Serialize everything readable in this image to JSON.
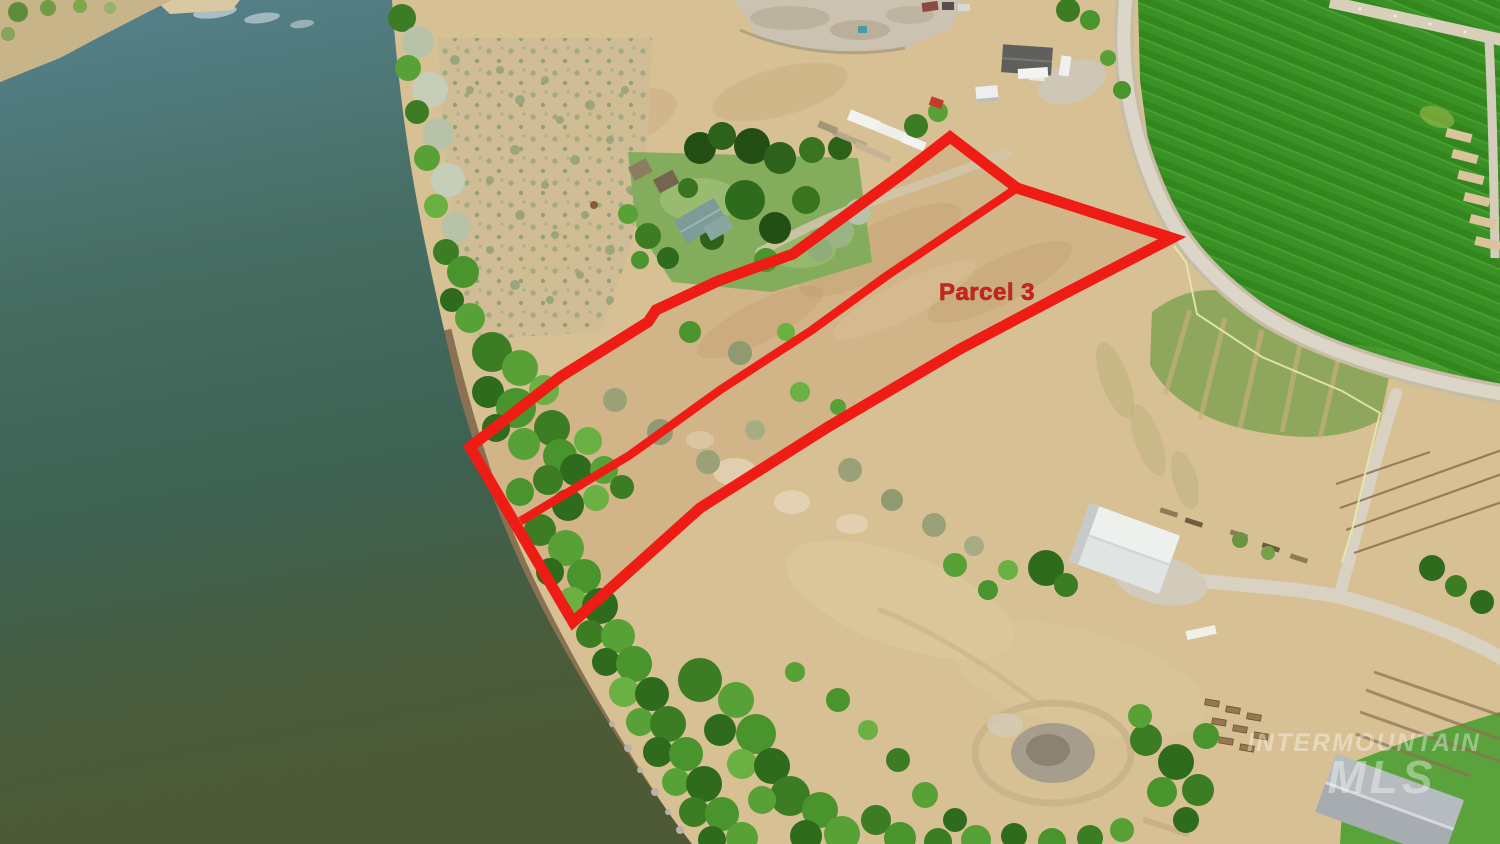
{
  "annotation": {
    "parcel_label": "Parcel 3",
    "outer_boundary_points": "950,137 1017,188 1172,238 1060,296 960,349 828,427 700,508 573,622 470,447 560,377 648,322 656,310 718,281 793,254 905,172",
    "divider_line_points": "1017,188 885,277 812,330 720,390 630,455 524,519"
  },
  "watermark": {
    "line1": "INTERMOUNTAIN",
    "line2": "MLS"
  },
  "colors": {
    "annotation_red": "#ee1c15",
    "label_red": "#c8241c",
    "watermark_white": "#ffffff"
  }
}
